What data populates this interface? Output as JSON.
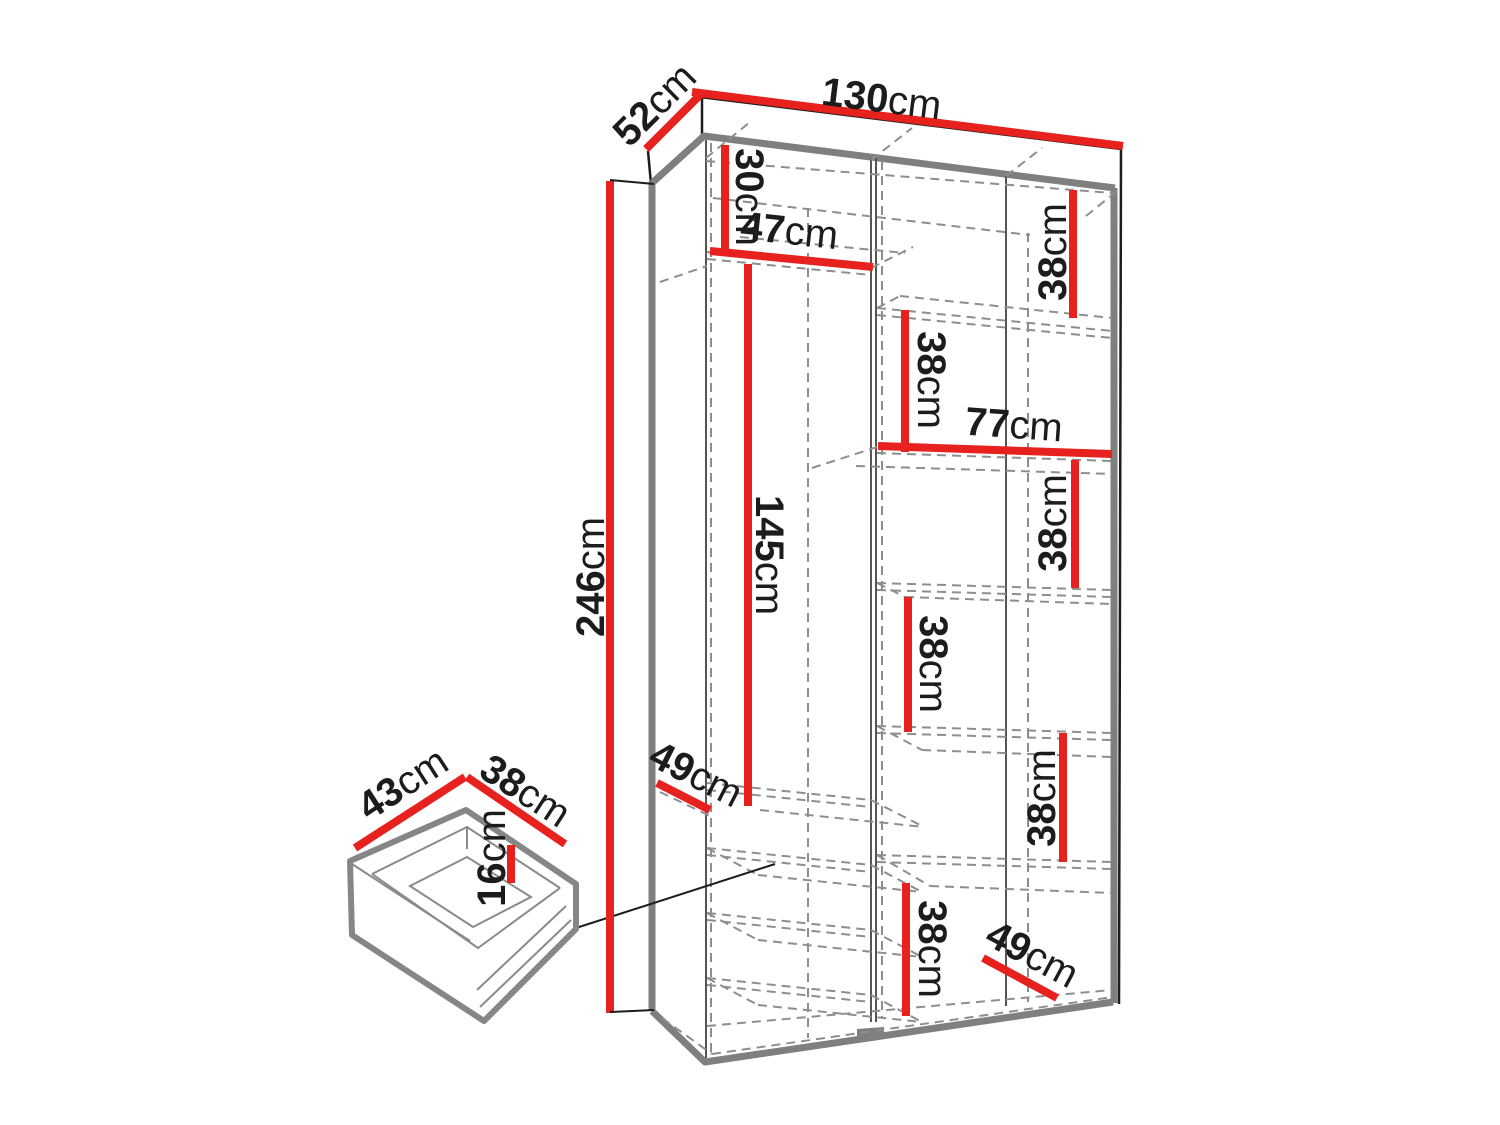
{
  "colors": {
    "dimension_line": "#e7211d",
    "outline_black": "#1d1d1b",
    "frame_gray": "#7f7f7f",
    "dashed_gray": "#8e8e8e",
    "text": "#1c1c1c",
    "background": "#ffffff"
  },
  "wardrobe": {
    "overall": {
      "width": {
        "value": "130",
        "unit": "cm"
      },
      "depth": {
        "value": "52",
        "unit": "cm"
      },
      "height": {
        "value": "246",
        "unit": "cm"
      }
    },
    "left_section": {
      "top_compartment_height": {
        "value": "30",
        "unit": "cm"
      },
      "width": {
        "value": "47",
        "unit": "cm"
      },
      "hanging_height": {
        "value": "145",
        "unit": "cm"
      },
      "shelf_depth": {
        "value": "49",
        "unit": "cm"
      }
    },
    "right_section": {
      "width": {
        "value": "77",
        "unit": "cm"
      },
      "compartment_heights": [
        {
          "value": "38",
          "unit": "cm"
        },
        {
          "value": "38",
          "unit": "cm"
        },
        {
          "value": "38",
          "unit": "cm"
        },
        {
          "value": "38",
          "unit": "cm"
        },
        {
          "value": "38",
          "unit": "cm"
        },
        {
          "value": "38",
          "unit": "cm"
        }
      ],
      "bottom_shelf_depth": {
        "value": "49",
        "unit": "cm"
      }
    }
  },
  "drawer": {
    "width": {
      "value": "43",
      "unit": "cm"
    },
    "depth": {
      "value": "38",
      "unit": "cm"
    },
    "height": {
      "value": "16",
      "unit": "cm"
    }
  }
}
